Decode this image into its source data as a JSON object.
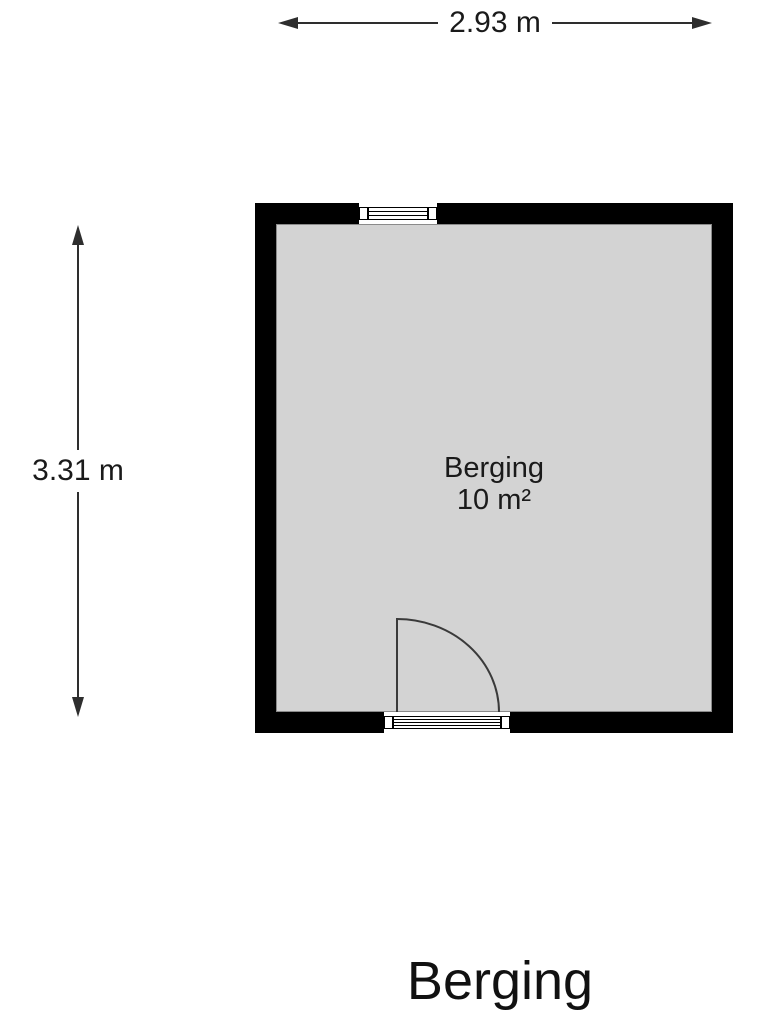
{
  "floorplan": {
    "dimensions": {
      "width": "2.93 m",
      "height": "3.31 m"
    },
    "room": {
      "name": "Berging",
      "area": "10 m²"
    },
    "icons": {
      "window": "window-symbol-top-wall",
      "door": "quarter-circle-door-swing-bottom-wall",
      "dimension_arrows": "double-headed-arrows"
    },
    "colors": {
      "wall": "#000000",
      "floor": "#d3d3d3",
      "line": "#2e2e2e",
      "text": "#1a1a1a",
      "bg": "#ffffff"
    }
  },
  "footer": {
    "title": "Berging"
  }
}
